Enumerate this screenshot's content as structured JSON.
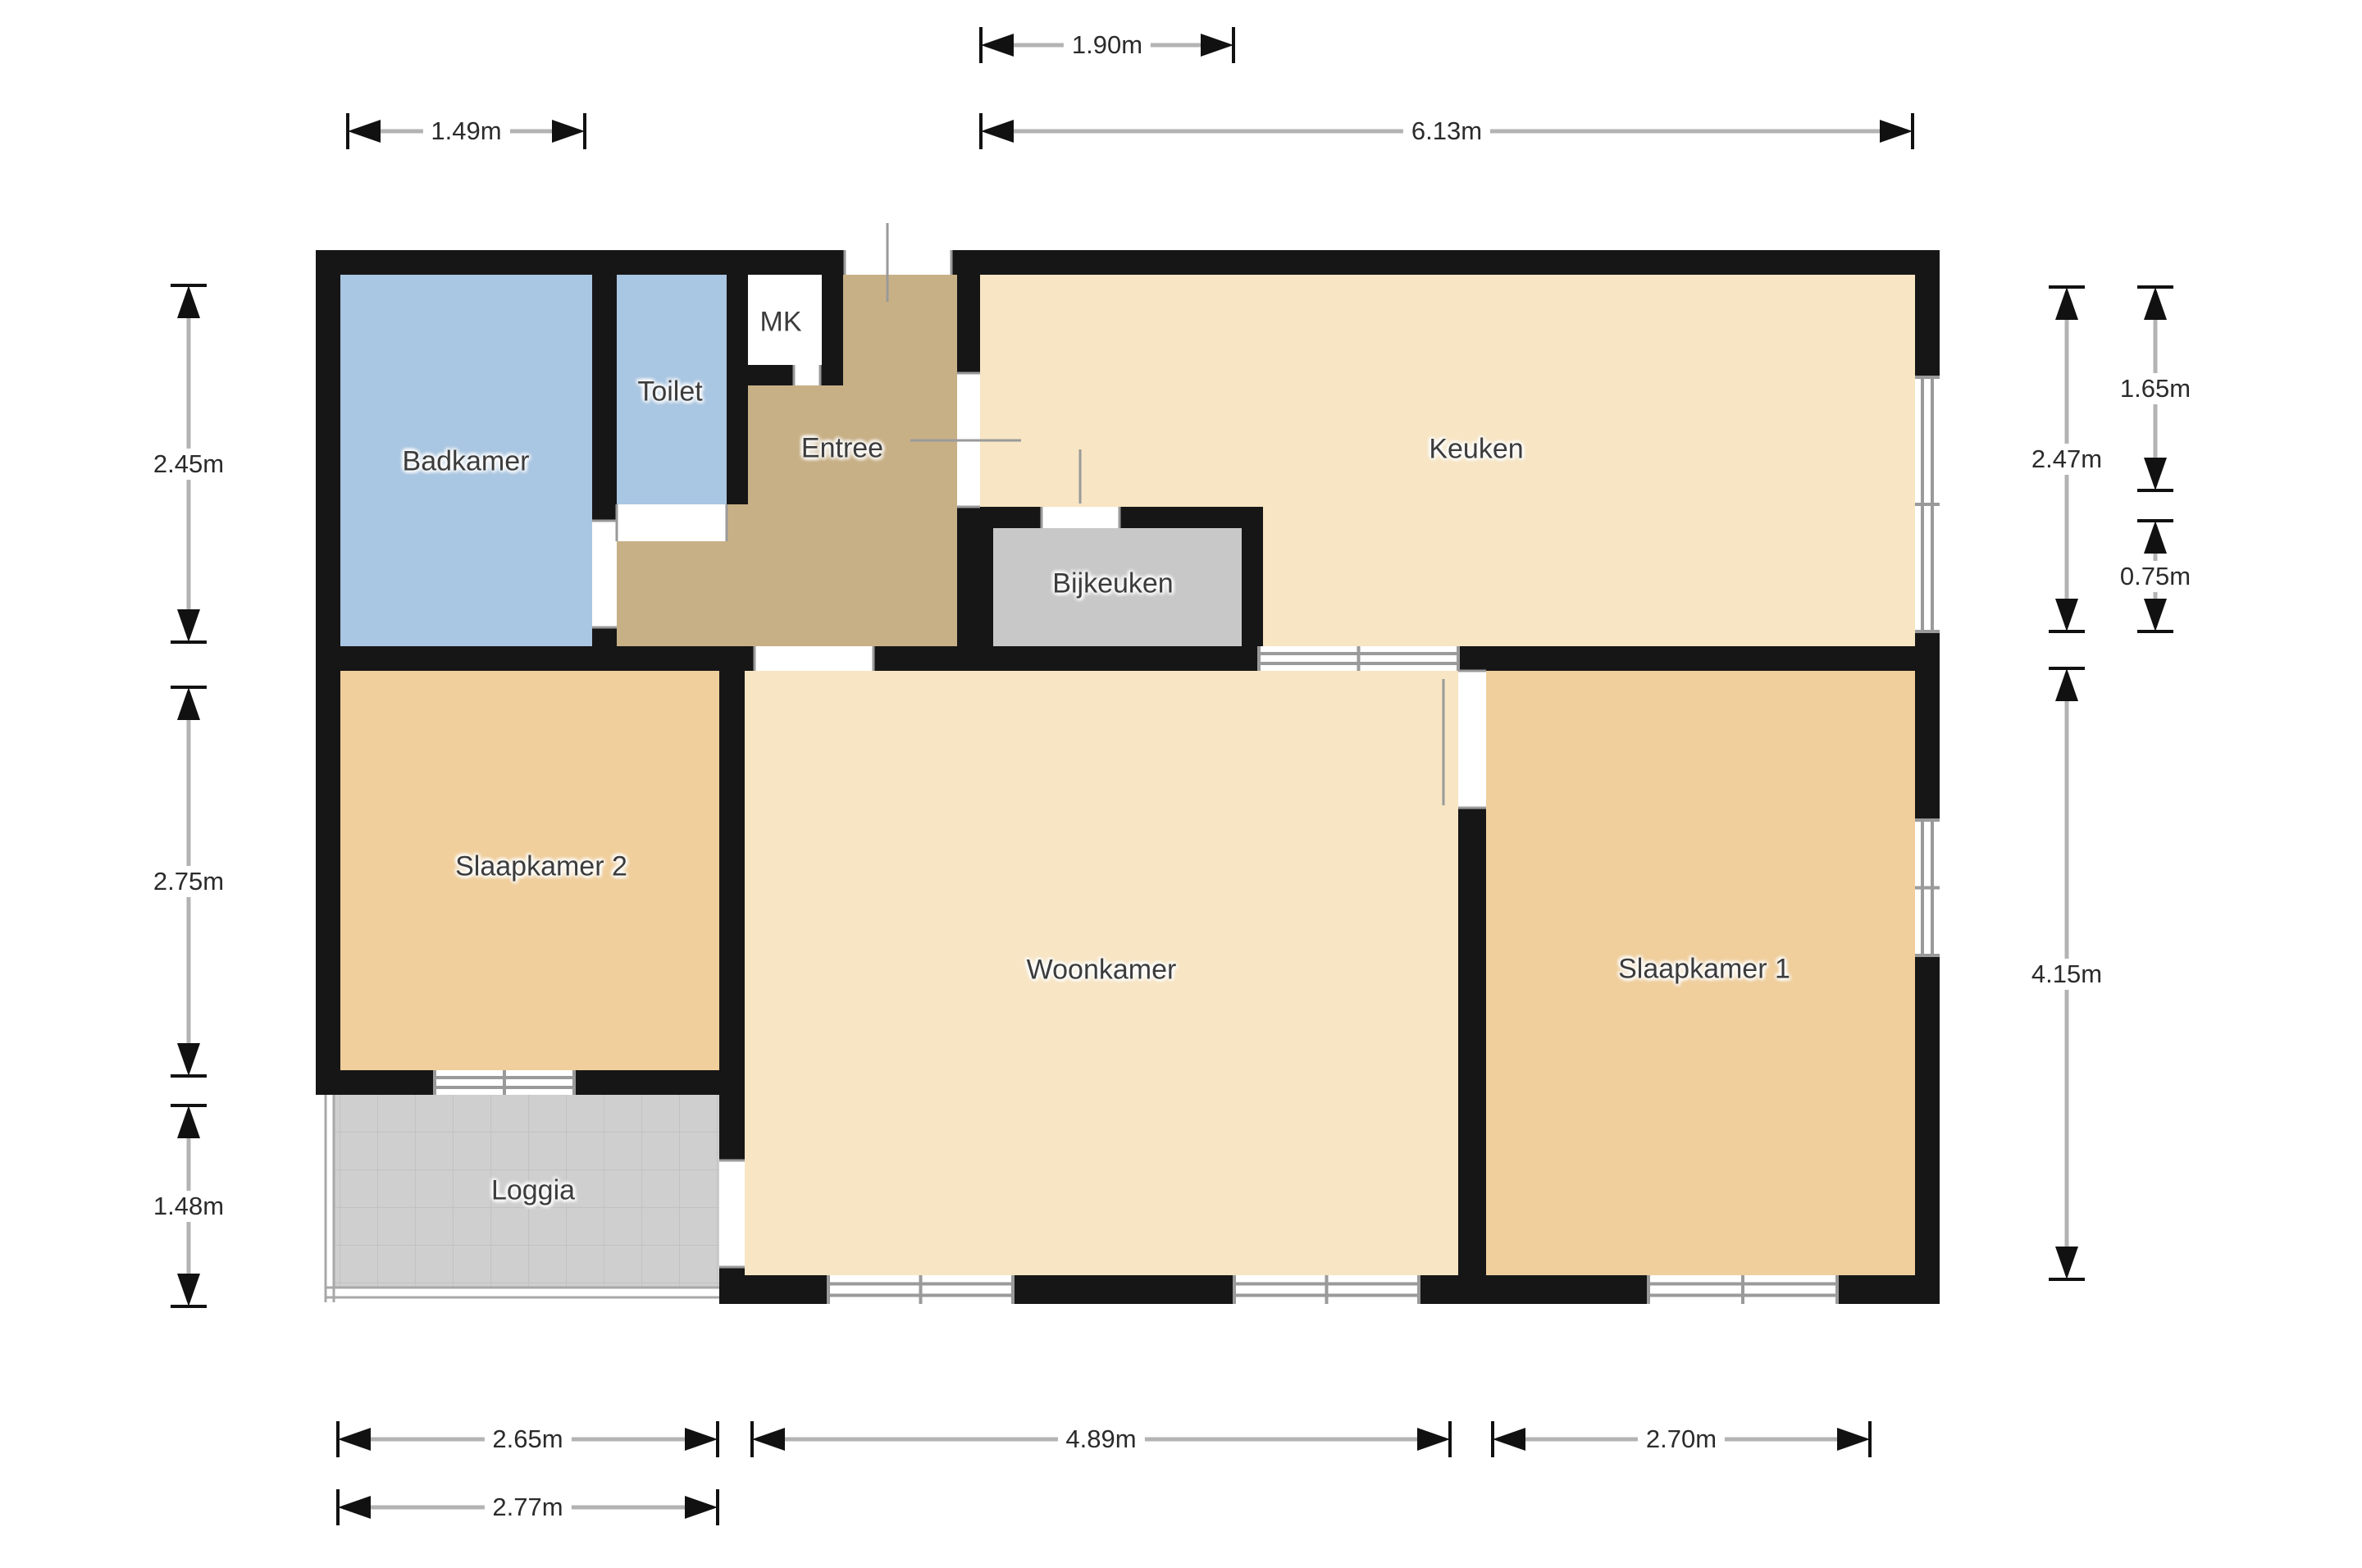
{
  "document": {
    "type": "floor-plan",
    "language": "nl"
  },
  "rooms": {
    "badkamer": "Badkamer",
    "toilet": "Toilet",
    "mk": "MK",
    "entree": "Entree",
    "keuken": "Keuken",
    "bijkeuken": "Bijkeuken",
    "slaapkamer2": "Slaapkamer 2",
    "woonkamer": "Woonkamer",
    "slaapkamer1": "Slaapkamer 1",
    "loggia": "Loggia"
  },
  "dimensions": {
    "top_small": "1.90m",
    "top_left": "1.49m",
    "top_right": "6.13m",
    "left_1": "2.45m",
    "left_2": "2.75m",
    "left_3": "1.48m",
    "right_inner_1": "2.47m",
    "right_inner_2": "4.15m",
    "right_outer_1": "1.65m",
    "right_outer_2": "0.75m",
    "bottom_1": "2.65m",
    "bottom_2": "4.89m",
    "bottom_3": "2.70m",
    "bottom_4": "2.77m"
  },
  "colors": {
    "wall": "#161616",
    "wet_room": "#a9c6e2",
    "hall": "#c8b086",
    "living": "#f7e5c3",
    "bedroom": "#f0cf9c",
    "utility": "#c8c8c8",
    "loggia": "#cfcfcf",
    "window_frame": "#9a9a9a",
    "dimension_line": "#b3b3b3",
    "dimension_text": "#2b2b2b",
    "label_text": "#3c3c3c"
  }
}
